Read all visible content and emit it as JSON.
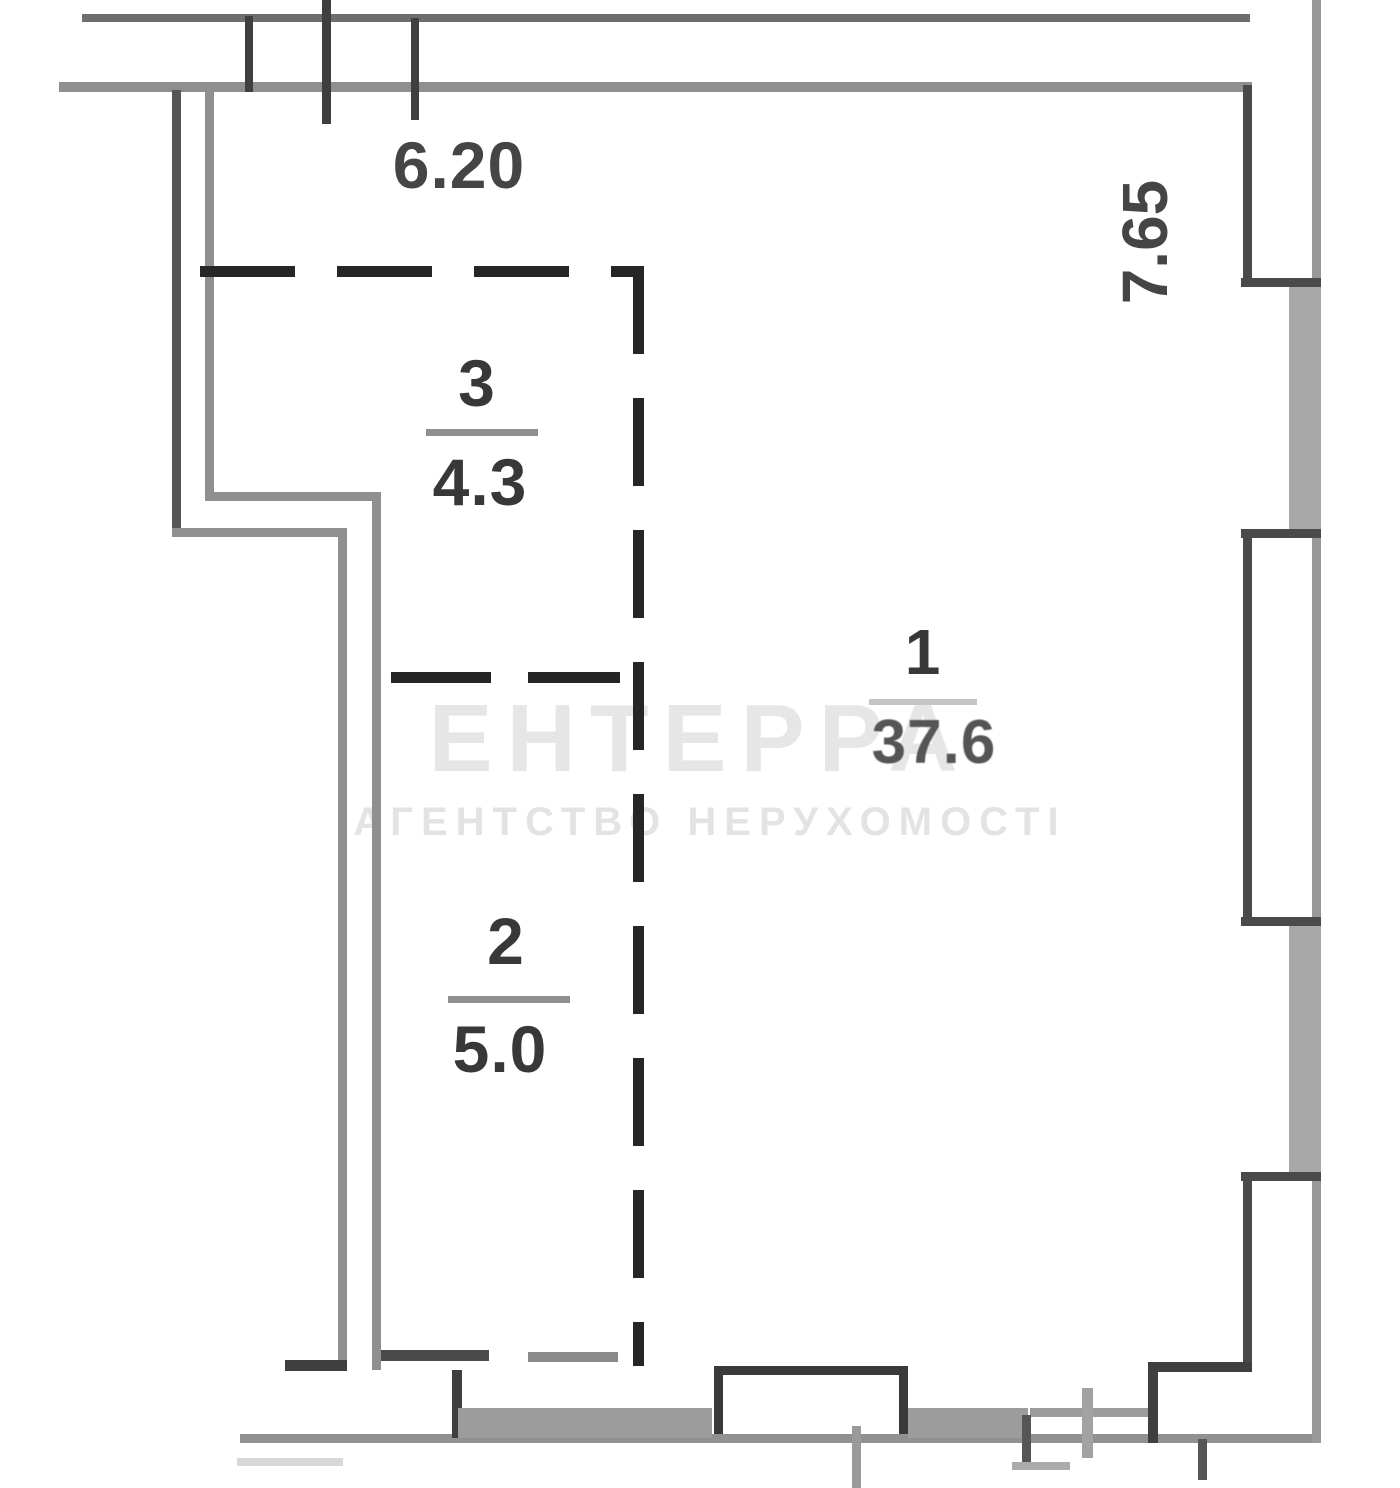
{
  "plan": {
    "dimensions": {
      "top": "6.20",
      "right": "7.65"
    },
    "rooms": [
      {
        "number": "1",
        "area": "37.6"
      },
      {
        "number": "2",
        "area": "5.0"
      },
      {
        "number": "3",
        "area": "4.3"
      }
    ],
    "watermark": {
      "line1": "ЕНТЕРРА",
      "line2": "АГЕНТСТВО НЕРУХОМОСТІ"
    },
    "colors": {
      "wall_dark": "#3f3f3f",
      "wall_mid": "#8f8f8f",
      "wall_fill": "#a8a8a8",
      "dash": "#262626",
      "label_text": "#383838"
    }
  }
}
